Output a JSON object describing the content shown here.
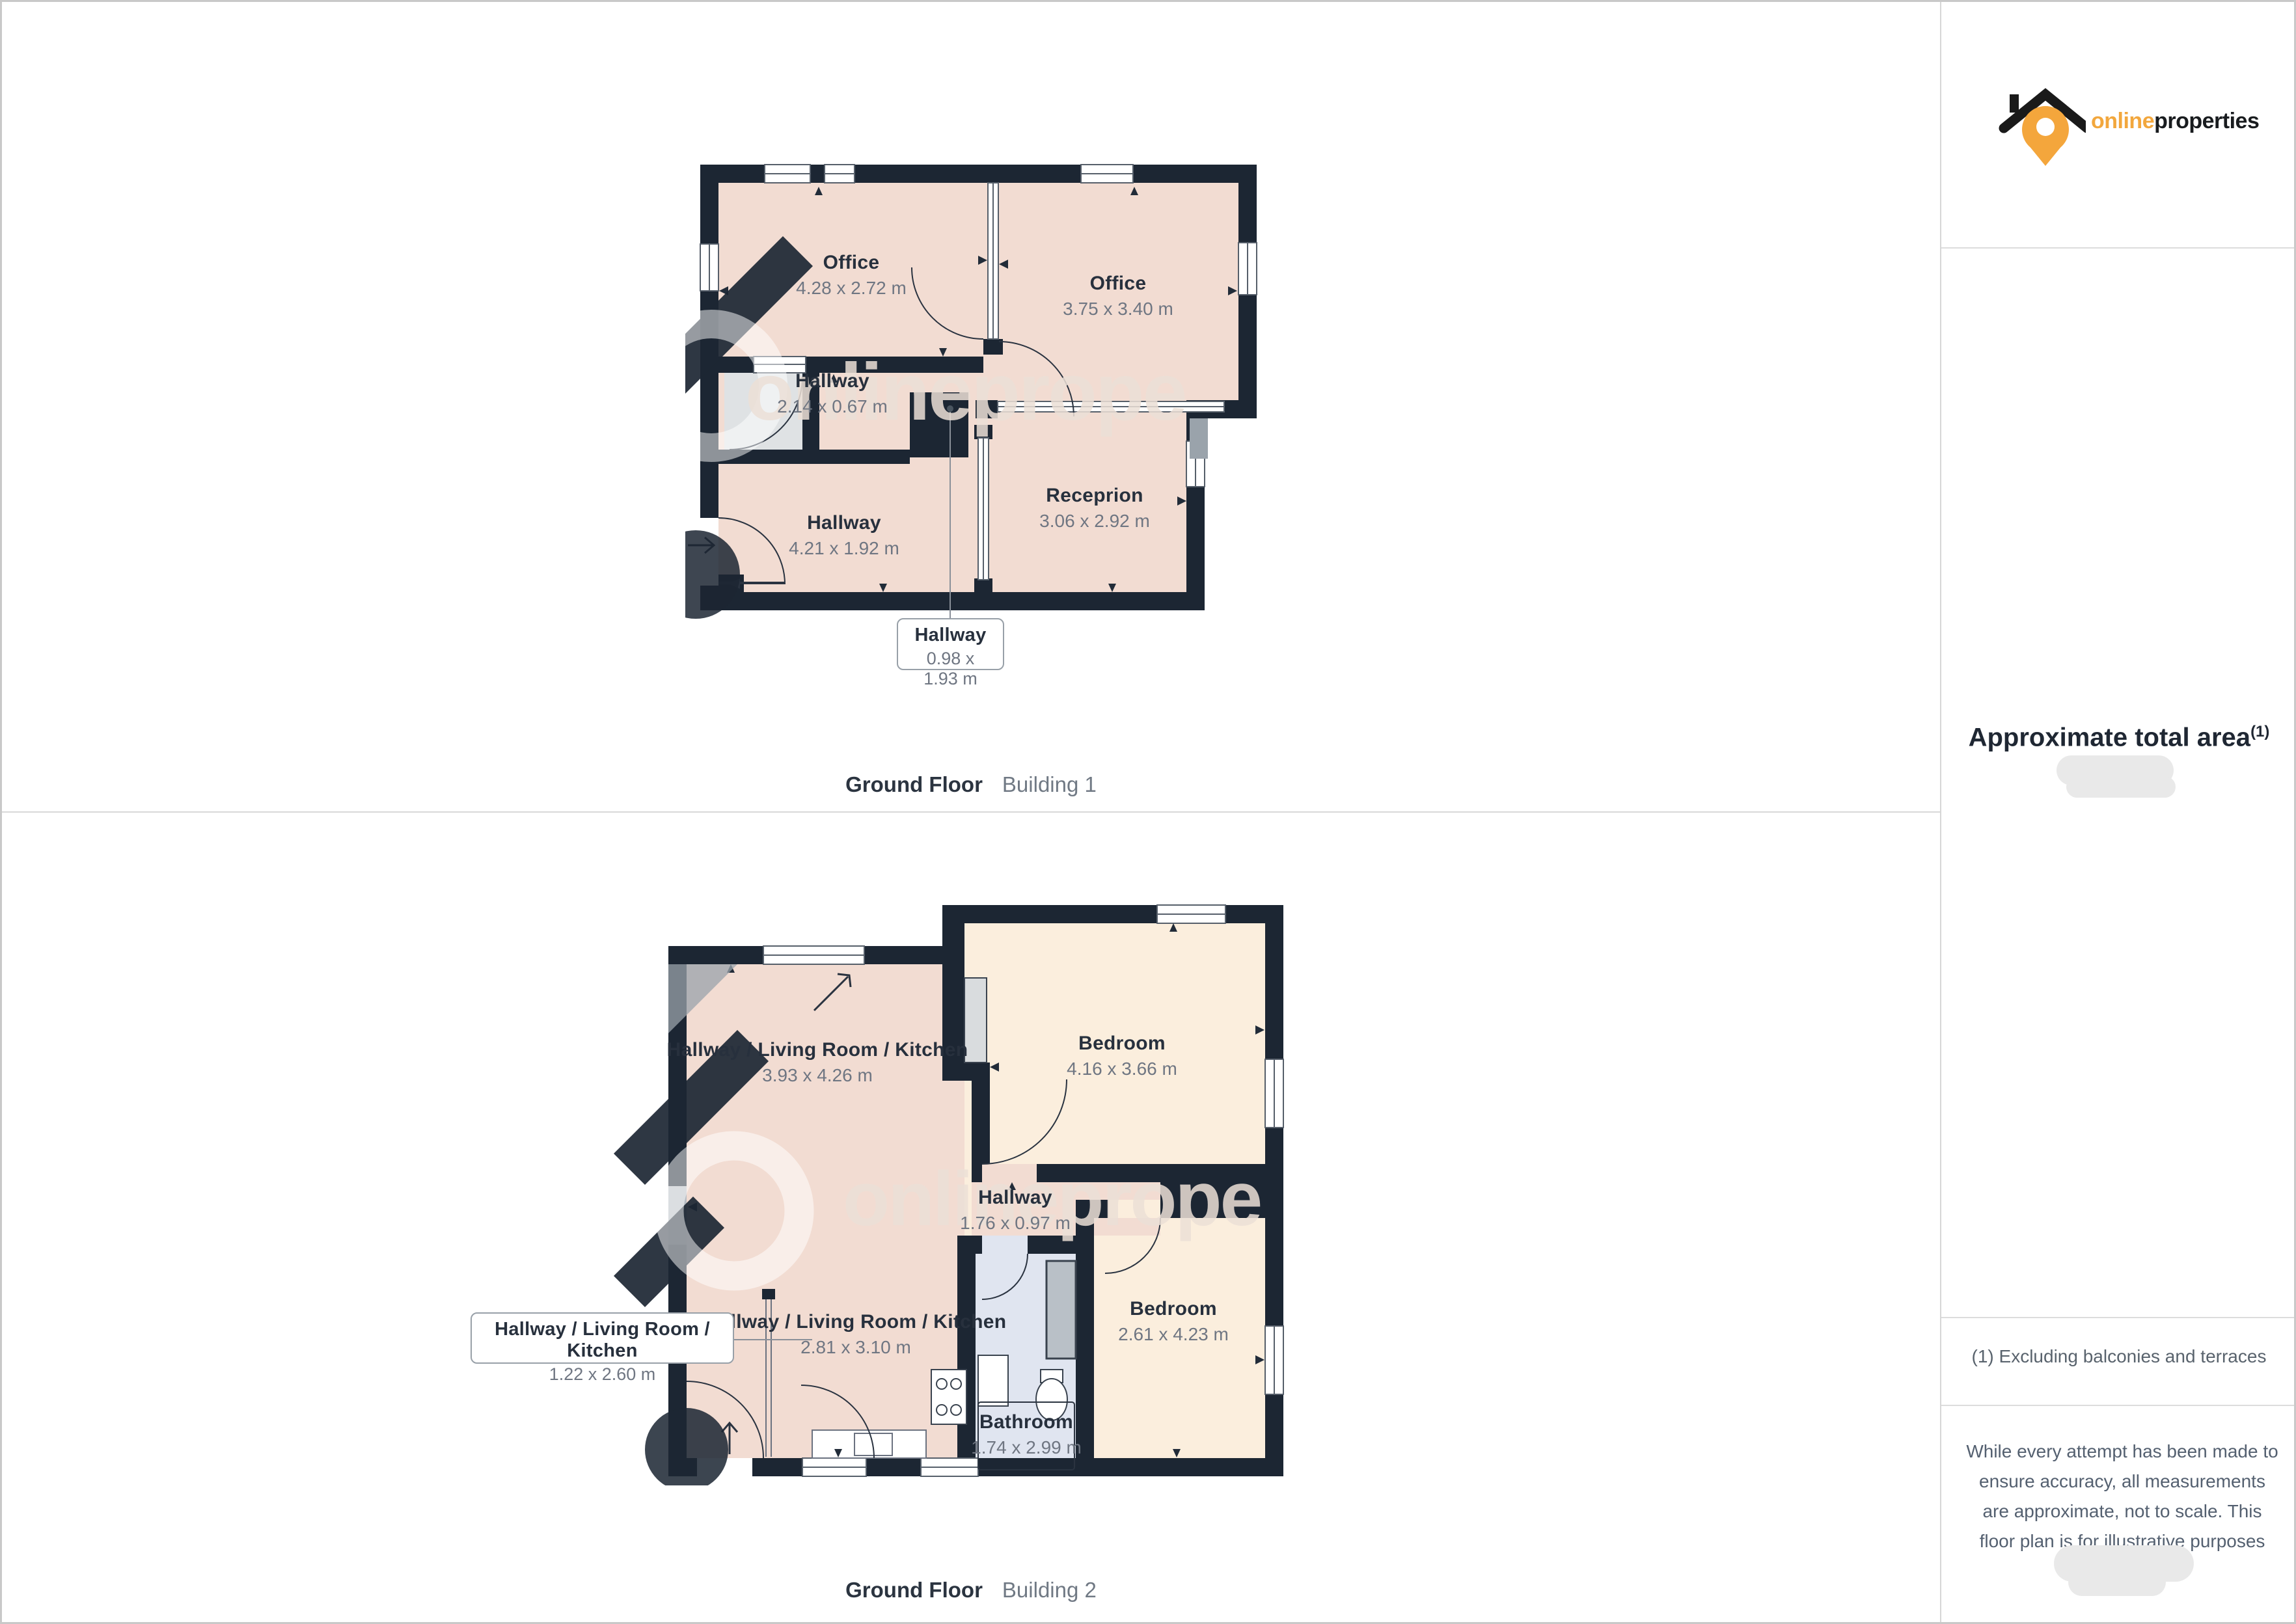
{
  "logo": {
    "brand_orange": "online",
    "brand_dark": "properties"
  },
  "sidebar": {
    "area_heading": "Approximate total area",
    "area_sup": "(1)",
    "footnote": "(1) Excluding balconies and terraces",
    "disclaimer": "While every attempt has been made to ensure accuracy, all measurements are approximate, not to scale. This floor plan is for illustrative purposes only."
  },
  "watermark": {
    "text": "onlineprope"
  },
  "colors": {
    "brand_orange": "#f2a73d",
    "wall": "#1c2633",
    "room_pink": "#f2dcd2",
    "room_cream": "#fbeedd",
    "bathroom_blue": "#e0e5f0"
  },
  "floor1": {
    "caption_title": "Ground Floor",
    "caption_sub": "Building 1",
    "rooms": {
      "office_left": {
        "name": "Office",
        "dims": "4.28 x 2.72 m"
      },
      "office_right": {
        "name": "Office",
        "dims": "3.75 x 3.40 m"
      },
      "hallway_small": {
        "name": "Hallway",
        "dims": "2.14 x 0.67 m"
      },
      "hallway_main": {
        "name": "Hallway",
        "dims": "4.21 x 1.92 m"
      },
      "reception": {
        "name": "Receprion",
        "dims": "3.06 x 2.92 m"
      },
      "callout": {
        "name": "Hallway",
        "dims": "0.98 x 1.93 m"
      }
    }
  },
  "floor2": {
    "caption_title": "Ground Floor",
    "caption_sub": "Building 2",
    "rooms": {
      "hlk_main": {
        "name": "Hallway / Living Room / Kitchen",
        "dims": "3.93 x 4.26 m"
      },
      "bedroom_top": {
        "name": "Bedroom",
        "dims": "4.16 x 3.66 m"
      },
      "hallway_mid": {
        "name": "Hallway",
        "dims": "1.76 x 0.97 m"
      },
      "hlk_lower": {
        "name": "Hallway / Living Room / Kitchen",
        "dims": "2.81 x 3.10 m"
      },
      "bedroom_bottom": {
        "name": "Bedroom",
        "dims": "2.61 x 4.23 m"
      },
      "bathroom": {
        "name": "Bathroom",
        "dims": "1.74 x 2.99 m"
      },
      "callout": {
        "name": "Hallway / Living Room / Kitchen",
        "dims": "1.22 x 2.60 m"
      }
    }
  }
}
